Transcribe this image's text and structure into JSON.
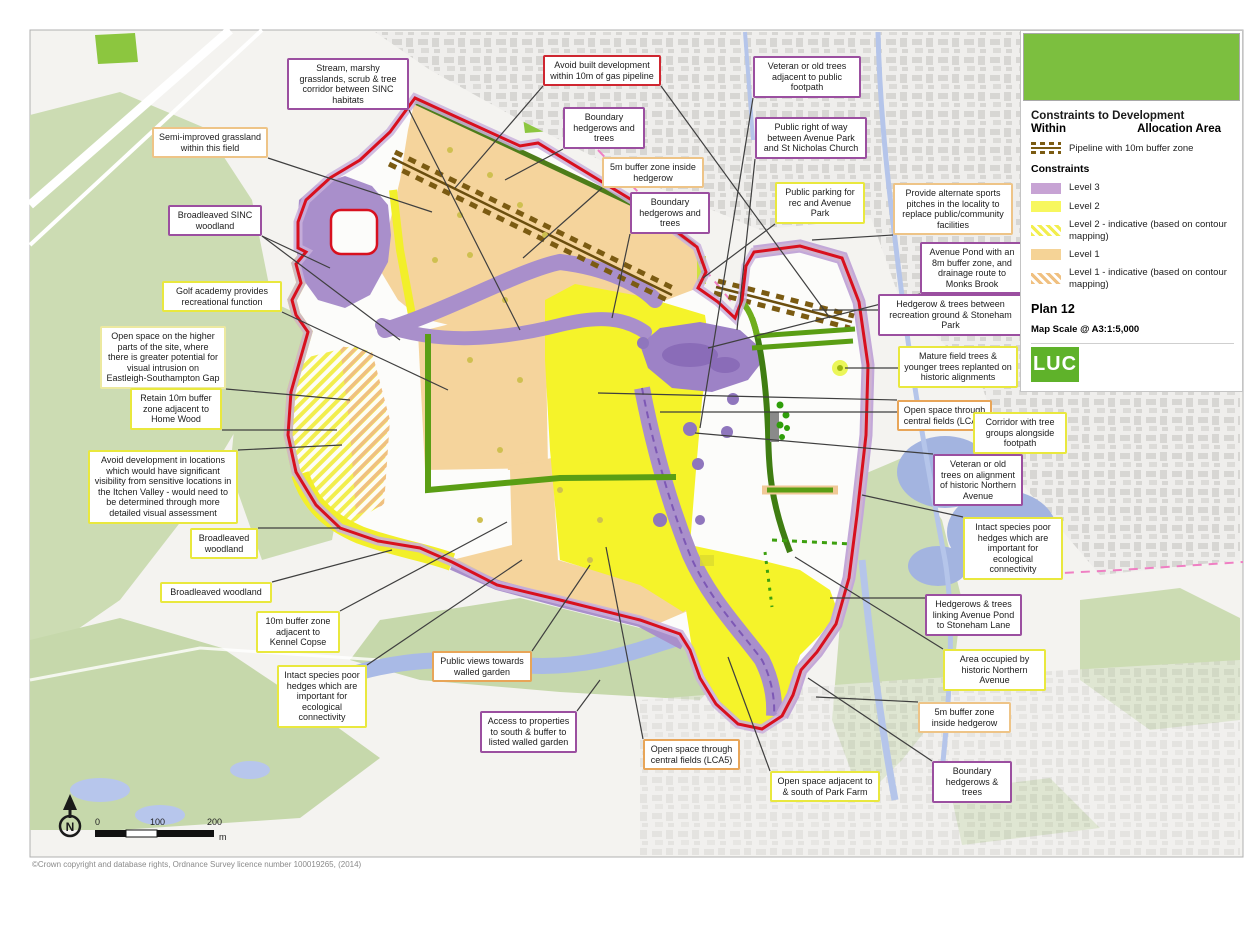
{
  "legend": {
    "title_line1": "Constraints to Development",
    "title_line2_left": "Within",
    "title_line2_right": "Allocation Area",
    "pipeline_label": "Pipeline with 10m buffer zone",
    "constraints_heading": "Constraints",
    "items": [
      {
        "label": "Level 3"
      },
      {
        "label": "Level 2"
      },
      {
        "label": "Level 2 - indicative (based on contour mapping)"
      },
      {
        "label": "Level 1"
      },
      {
        "label": "Level 1 - indicative (based on contour mapping)"
      }
    ],
    "plan_label": "Plan 12",
    "scale_label": "Map Scale @ A3:1:5,000",
    "logo_text": "LUC"
  },
  "scalebar": {
    "tick0": "0",
    "tick100": "100",
    "tick200": "200",
    "unit": "m",
    "north_label": "N"
  },
  "footer": {
    "copyright": "©Crown copyright and database rights, Ordnance Survey licence number 100019265, (2014)"
  },
  "colors": {
    "boundary_red": "#d8101e",
    "level1_orange": "#f5d49c",
    "level2_yellow": "#f5f32a",
    "level3_purple": "#a98fcb",
    "hedge_green": "#5a9e14",
    "pipeline_brown": "#7b5b12",
    "water_blue": "#a3b4e0",
    "woodland_green": "#ccdcb3",
    "legend_green": "#7cbf3f"
  },
  "annotations": [
    {
      "id": "stream-corridor",
      "type": "purple",
      "box": [
        287,
        58,
        122
      ],
      "anchors": [
        [
          520,
          330
        ]
      ],
      "text": "Stream, marshy grasslands, scrub & tree corridor between SINC habitats"
    },
    {
      "id": "avoid-gas-pipeline",
      "type": "red",
      "box": [
        543,
        55,
        118
      ],
      "anchors": [
        [
          455,
          188
        ],
        [
          830,
          318
        ]
      ],
      "text": "Avoid built development within 10m of gas pipeline"
    },
    {
      "id": "boundary-hedgerows-1",
      "type": "purple",
      "box": [
        563,
        107,
        82
      ],
      "anchors": [
        [
          505,
          180
        ]
      ],
      "text": "Boundary hedgerows and trees"
    },
    {
      "id": "buffer-hedgerow-top",
      "type": "paleorange",
      "box": [
        602,
        157,
        102
      ],
      "anchors": [
        [
          523,
          258
        ]
      ],
      "text": "5m buffer zone inside hedgerow"
    },
    {
      "id": "boundary-hedgerows-2",
      "type": "purple",
      "box": [
        630,
        192,
        80
      ],
      "anchors": [
        [
          612,
          318
        ]
      ],
      "text": "Boundary hedgerows and trees"
    },
    {
      "id": "veteran-trees-footpath",
      "type": "purple",
      "box": [
        753,
        56,
        108
      ],
      "anchors": [
        [
          700,
          428
        ]
      ],
      "text": "Veteran or old trees adjacent to public footpath"
    },
    {
      "id": "public-right-of-way",
      "type": "purple",
      "box": [
        755,
        117,
        112
      ],
      "anchors": [
        [
          737,
          330
        ]
      ],
      "text": "Public right of way between Avenue Park and St Nicholas Church"
    },
    {
      "id": "public-parking",
      "type": "yellow",
      "box": [
        775,
        182,
        90
      ],
      "anchors": [
        [
          703,
          278
        ]
      ],
      "text": "Public parking for rec and Avenue Park"
    },
    {
      "id": "alternate-sports-pitches",
      "type": "paleorange",
      "box": [
        893,
        183,
        120
      ],
      "anchors": [
        [
          812,
          240
        ]
      ],
      "text": "Provide alternate sports pitches in the locality to replace public/community facilities"
    },
    {
      "id": "avenue-pond",
      "type": "purple",
      "box": [
        920,
        242,
        104
      ],
      "anchors": [
        [
          708,
          348
        ]
      ],
      "text": "Avenue Pond with an 8m buffer zone, and drainage route to Monks Brook"
    },
    {
      "id": "hedgerow-rec-stoneham",
      "type": "purple",
      "box": [
        878,
        294,
        145
      ],
      "anchors": [
        [
          812,
          310
        ]
      ],
      "text": "Hedgerow & trees between recreation ground & Stoneham Park"
    },
    {
      "id": "mature-field-trees",
      "type": "yellow",
      "box": [
        898,
        346,
        120
      ],
      "anchors": [
        [
          845,
          368
        ]
      ],
      "text": "Mature field trees & younger trees replanted on historic alignments"
    },
    {
      "id": "open-space-lca5-right",
      "type": "orange",
      "box": [
        897,
        400,
        95
      ],
      "anchors": [
        [
          598,
          393
        ]
      ],
      "text": "Open space through central fields (LCA5)"
    },
    {
      "id": "corridor-tree-groups",
      "type": "yellow",
      "box": [
        973,
        412,
        94
      ],
      "anchors": [
        [
          660,
          412
        ]
      ],
      "text": "Corridor with tree groups alongside footpath"
    },
    {
      "id": "veteran-trees-northern-avenue",
      "type": "purple",
      "box": [
        933,
        454,
        90
      ],
      "anchors": [
        [
          695,
          433
        ]
      ],
      "text": "Veteran or old trees on alignment of historic Northern Avenue"
    },
    {
      "id": "intact-hedges-right",
      "type": "yellow",
      "box": [
        963,
        517,
        100
      ],
      "anchors": [
        [
          862,
          495
        ]
      ],
      "text": "Intact species poor hedges which are important for ecological connectivity"
    },
    {
      "id": "hedgerows-linking",
      "type": "purple",
      "box": [
        925,
        594,
        97
      ],
      "anchors": [
        [
          830,
          598
        ]
      ],
      "text": "Hedgerows & trees linking Avenue Pond to Stoneham Lane"
    },
    {
      "id": "area-historic-northern-avenue",
      "type": "yellow",
      "box": [
        943,
        649,
        103
      ],
      "anchors": [
        [
          795,
          557
        ]
      ],
      "text": "Area occupied by historic Northern Avenue"
    },
    {
      "id": "buffer-hedgerow-right",
      "type": "paleorange",
      "box": [
        918,
        702,
        93
      ],
      "anchors": [
        [
          816,
          697
        ]
      ],
      "text": "5m buffer zone inside hedgerow"
    },
    {
      "id": "boundary-hedgerows-3",
      "type": "purple",
      "box": [
        932,
        761,
        80
      ],
      "anchors": [
        [
          808,
          678
        ]
      ],
      "text": "Boundary hedgerows & trees"
    },
    {
      "id": "semi-improved-grassland",
      "type": "paleorange",
      "box": [
        152,
        127,
        116
      ],
      "anchors": [
        [
          432,
          212
        ]
      ],
      "text": "Semi-improved grassland within this field"
    },
    {
      "id": "broadleaved-sinc-woodland",
      "type": "purple",
      "box": [
        168,
        205,
        94
      ],
      "anchors": [
        [
          330,
          268
        ],
        [
          400,
          340
        ]
      ],
      "text": "Broadleaved SINC woodland"
    },
    {
      "id": "golf-academy",
      "type": "yellow",
      "box": [
        162,
        281,
        120
      ],
      "anchors": [
        [
          448,
          390
        ]
      ],
      "text": "Golf academy provides recreational function"
    },
    {
      "id": "open-space-higher-parts",
      "type": "paleyellow",
      "box": [
        100,
        326,
        126
      ],
      "anchors": [
        [
          350,
          400
        ]
      ],
      "text": "Open space on the higher parts of the site, where there is greater potential for visual intrusion on Eastleigh-Southampton Gap"
    },
    {
      "id": "retain-10m-home-wood",
      "type": "yellow",
      "box": [
        130,
        388,
        92
      ],
      "anchors": [
        [
          337,
          430
        ]
      ],
      "text": "Retain 10m buffer zone adjacent to Home Wood"
    },
    {
      "id": "avoid-dev-itchen-valley",
      "type": "yellow",
      "box": [
        88,
        450,
        150
      ],
      "anchors": [
        [
          342,
          445
        ]
      ],
      "text": "Avoid development in locations which would have significant visibility from sensitive locations in the Itchen Valley - would need to be determined through more detailed visual assessment"
    },
    {
      "id": "broadleaved-woodland-1",
      "type": "yellow",
      "box": [
        190,
        528,
        68
      ],
      "anchors": [
        [
          340,
          528
        ]
      ],
      "text": "Broadleaved woodland"
    },
    {
      "id": "broadleaved-woodland-2",
      "type": "yellow",
      "box": [
        160,
        582,
        112
      ],
      "anchors": [
        [
          392,
          550
        ]
      ],
      "text": "Broadleaved woodland"
    },
    {
      "id": "buffer-kennel-copse",
      "type": "yellow",
      "box": [
        256,
        611,
        84
      ],
      "anchors": [
        [
          507,
          522
        ]
      ],
      "text": "10m buffer zone adjacent to Kennel Copse"
    },
    {
      "id": "intact-hedges-left",
      "type": "yellow",
      "box": [
        277,
        665,
        90
      ],
      "anchors": [
        [
          522,
          560
        ]
      ],
      "text": "Intact species poor hedges which are important for ecological connectivity"
    },
    {
      "id": "public-views-walled-garden",
      "type": "orange",
      "box": [
        432,
        651,
        100
      ],
      "anchors": [
        [
          590,
          565
        ]
      ],
      "text": "Public views towards walled garden"
    },
    {
      "id": "access-properties-south",
      "type": "purple",
      "box": [
        480,
        711,
        97
      ],
      "anchors": [
        [
          600,
          680
        ]
      ],
      "text": "Access to properties to south & buffer to listed walled garden"
    },
    {
      "id": "open-space-lca5-bottom",
      "type": "orange",
      "box": [
        643,
        739,
        97
      ],
      "anchors": [
        [
          606,
          547
        ]
      ],
      "text": "Open space through central fields (LCA5)"
    },
    {
      "id": "open-space-park-farm",
      "type": "yellow",
      "box": [
        770,
        771,
        110
      ],
      "anchors": [
        [
          728,
          657
        ]
      ],
      "text": "Open space adjacent to & south of Park Farm"
    }
  ]
}
